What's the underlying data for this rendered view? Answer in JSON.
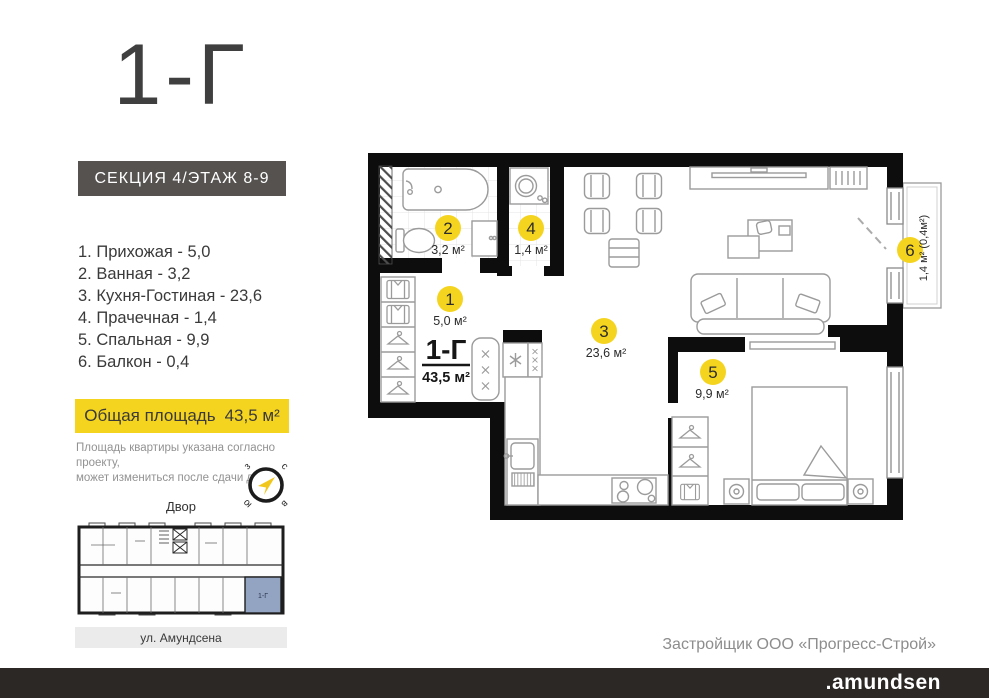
{
  "header": {
    "title": "1-Г",
    "section_badge": "СЕКЦИЯ 4/ЭТАЖ 8-9"
  },
  "rooms": [
    {
      "label": "1. Прихожая - 5,0"
    },
    {
      "label": "2. Ванная - 3,2"
    },
    {
      "label": "3. Кухня-Гостиная - 23,6"
    },
    {
      "label": "4. Прачечная - 1,4"
    },
    {
      "label": "5. Спальная - 9,9"
    },
    {
      "label": "6. Балкон - 0,4"
    }
  ],
  "total_area": {
    "label": "Общая площадь",
    "value": "43,5 м²"
  },
  "disclaimer": {
    "line1": "Площадь квартиры указана согласно проекту,",
    "line2": "может измениться  после сдачи дома"
  },
  "compass": {
    "n": "с",
    "e": "в",
    "s": "ю",
    "w": "з"
  },
  "mini_plan": {
    "top_label": "Двор",
    "bottom_label": "ул. Амундсена",
    "unit_label": "1-Г",
    "highlight_color": "#93a3c2"
  },
  "plan": {
    "apartment_label": "1-Г",
    "apartment_area": "43,5 м²",
    "marker_color": "#f5d41f",
    "markers": [
      {
        "num": "1",
        "area": "5,0 м²"
      },
      {
        "num": "2",
        "area": "3,2 м²"
      },
      {
        "num": "3",
        "area": "23,6 м²"
      },
      {
        "num": "4",
        "area": "1,4 м²"
      },
      {
        "num": "5",
        "area": "9,9 м²"
      },
      {
        "num": "6",
        "area": "1,4 м² (0,4м²)"
      }
    ]
  },
  "footer": {
    "developer": "Застройщик ООО «Прогресс-Строй»",
    "brand": ".amundsen"
  },
  "colors": {
    "accent_yellow": "#f5d41f",
    "wall_black": "#0d0d0d",
    "badge_gray": "#555250",
    "bar_dark": "#2b2826"
  }
}
